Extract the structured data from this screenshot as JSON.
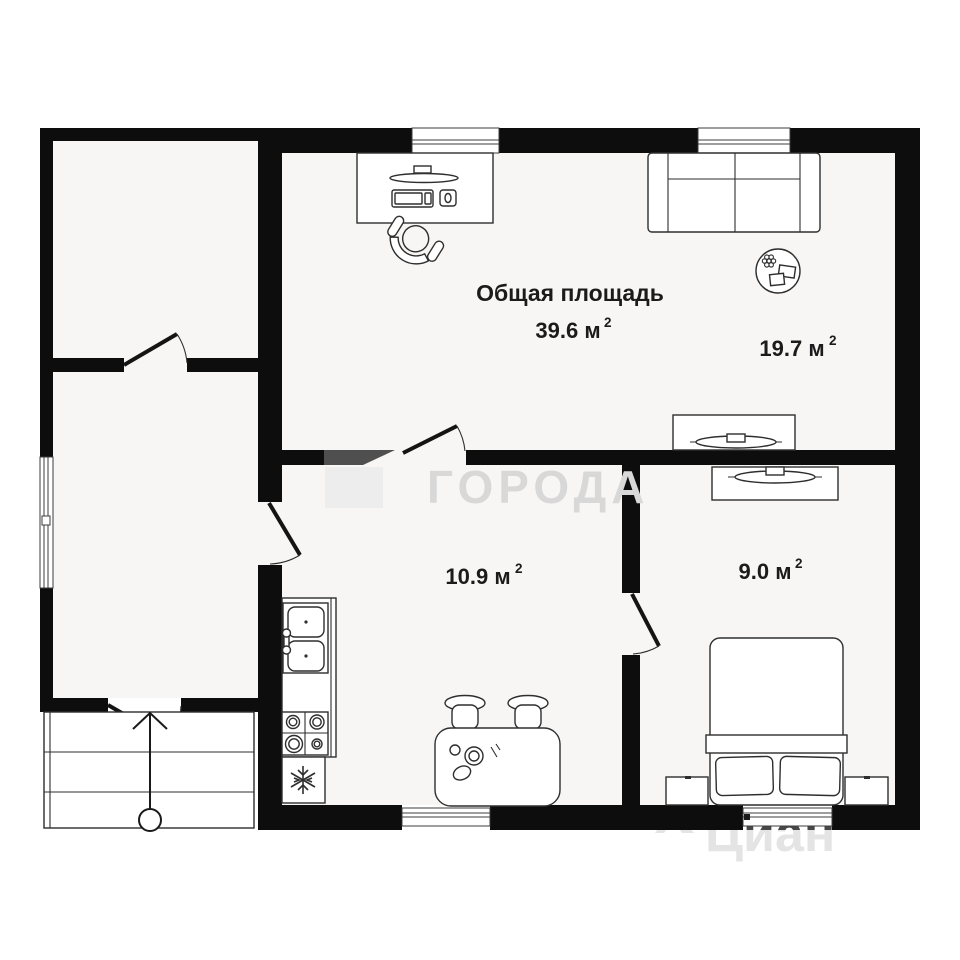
{
  "plan": {
    "title": "Общая площадь",
    "total_area": {
      "value": "39.6 м",
      "sup": "2"
    },
    "rooms": [
      {
        "id": "living-room",
        "area_value": "19.7 м",
        "area_sup": "2"
      },
      {
        "id": "kitchen",
        "area_value": "10.9 м",
        "area_sup": "2"
      },
      {
        "id": "bedroom",
        "area_value": "9.0 м",
        "area_sup": "2"
      }
    ]
  },
  "watermarks": {
    "center_text": "ГОРОДА",
    "corner_text": "Циан"
  },
  "icons": {
    "fridge": "snowflake-icon",
    "plant": "plant-icon",
    "entrance": "arrow-up-icon"
  },
  "colors": {
    "wall": "#0d0d0d",
    "floor_tint": "#f8f6f5",
    "label_text": "#1b1b1b",
    "furniture_line": "#2e2e2e",
    "watermark_light": "#d8d8d8",
    "watermark_dark": "#474747",
    "watermark_gray_wall_segment": "#4f4f4f"
  }
}
